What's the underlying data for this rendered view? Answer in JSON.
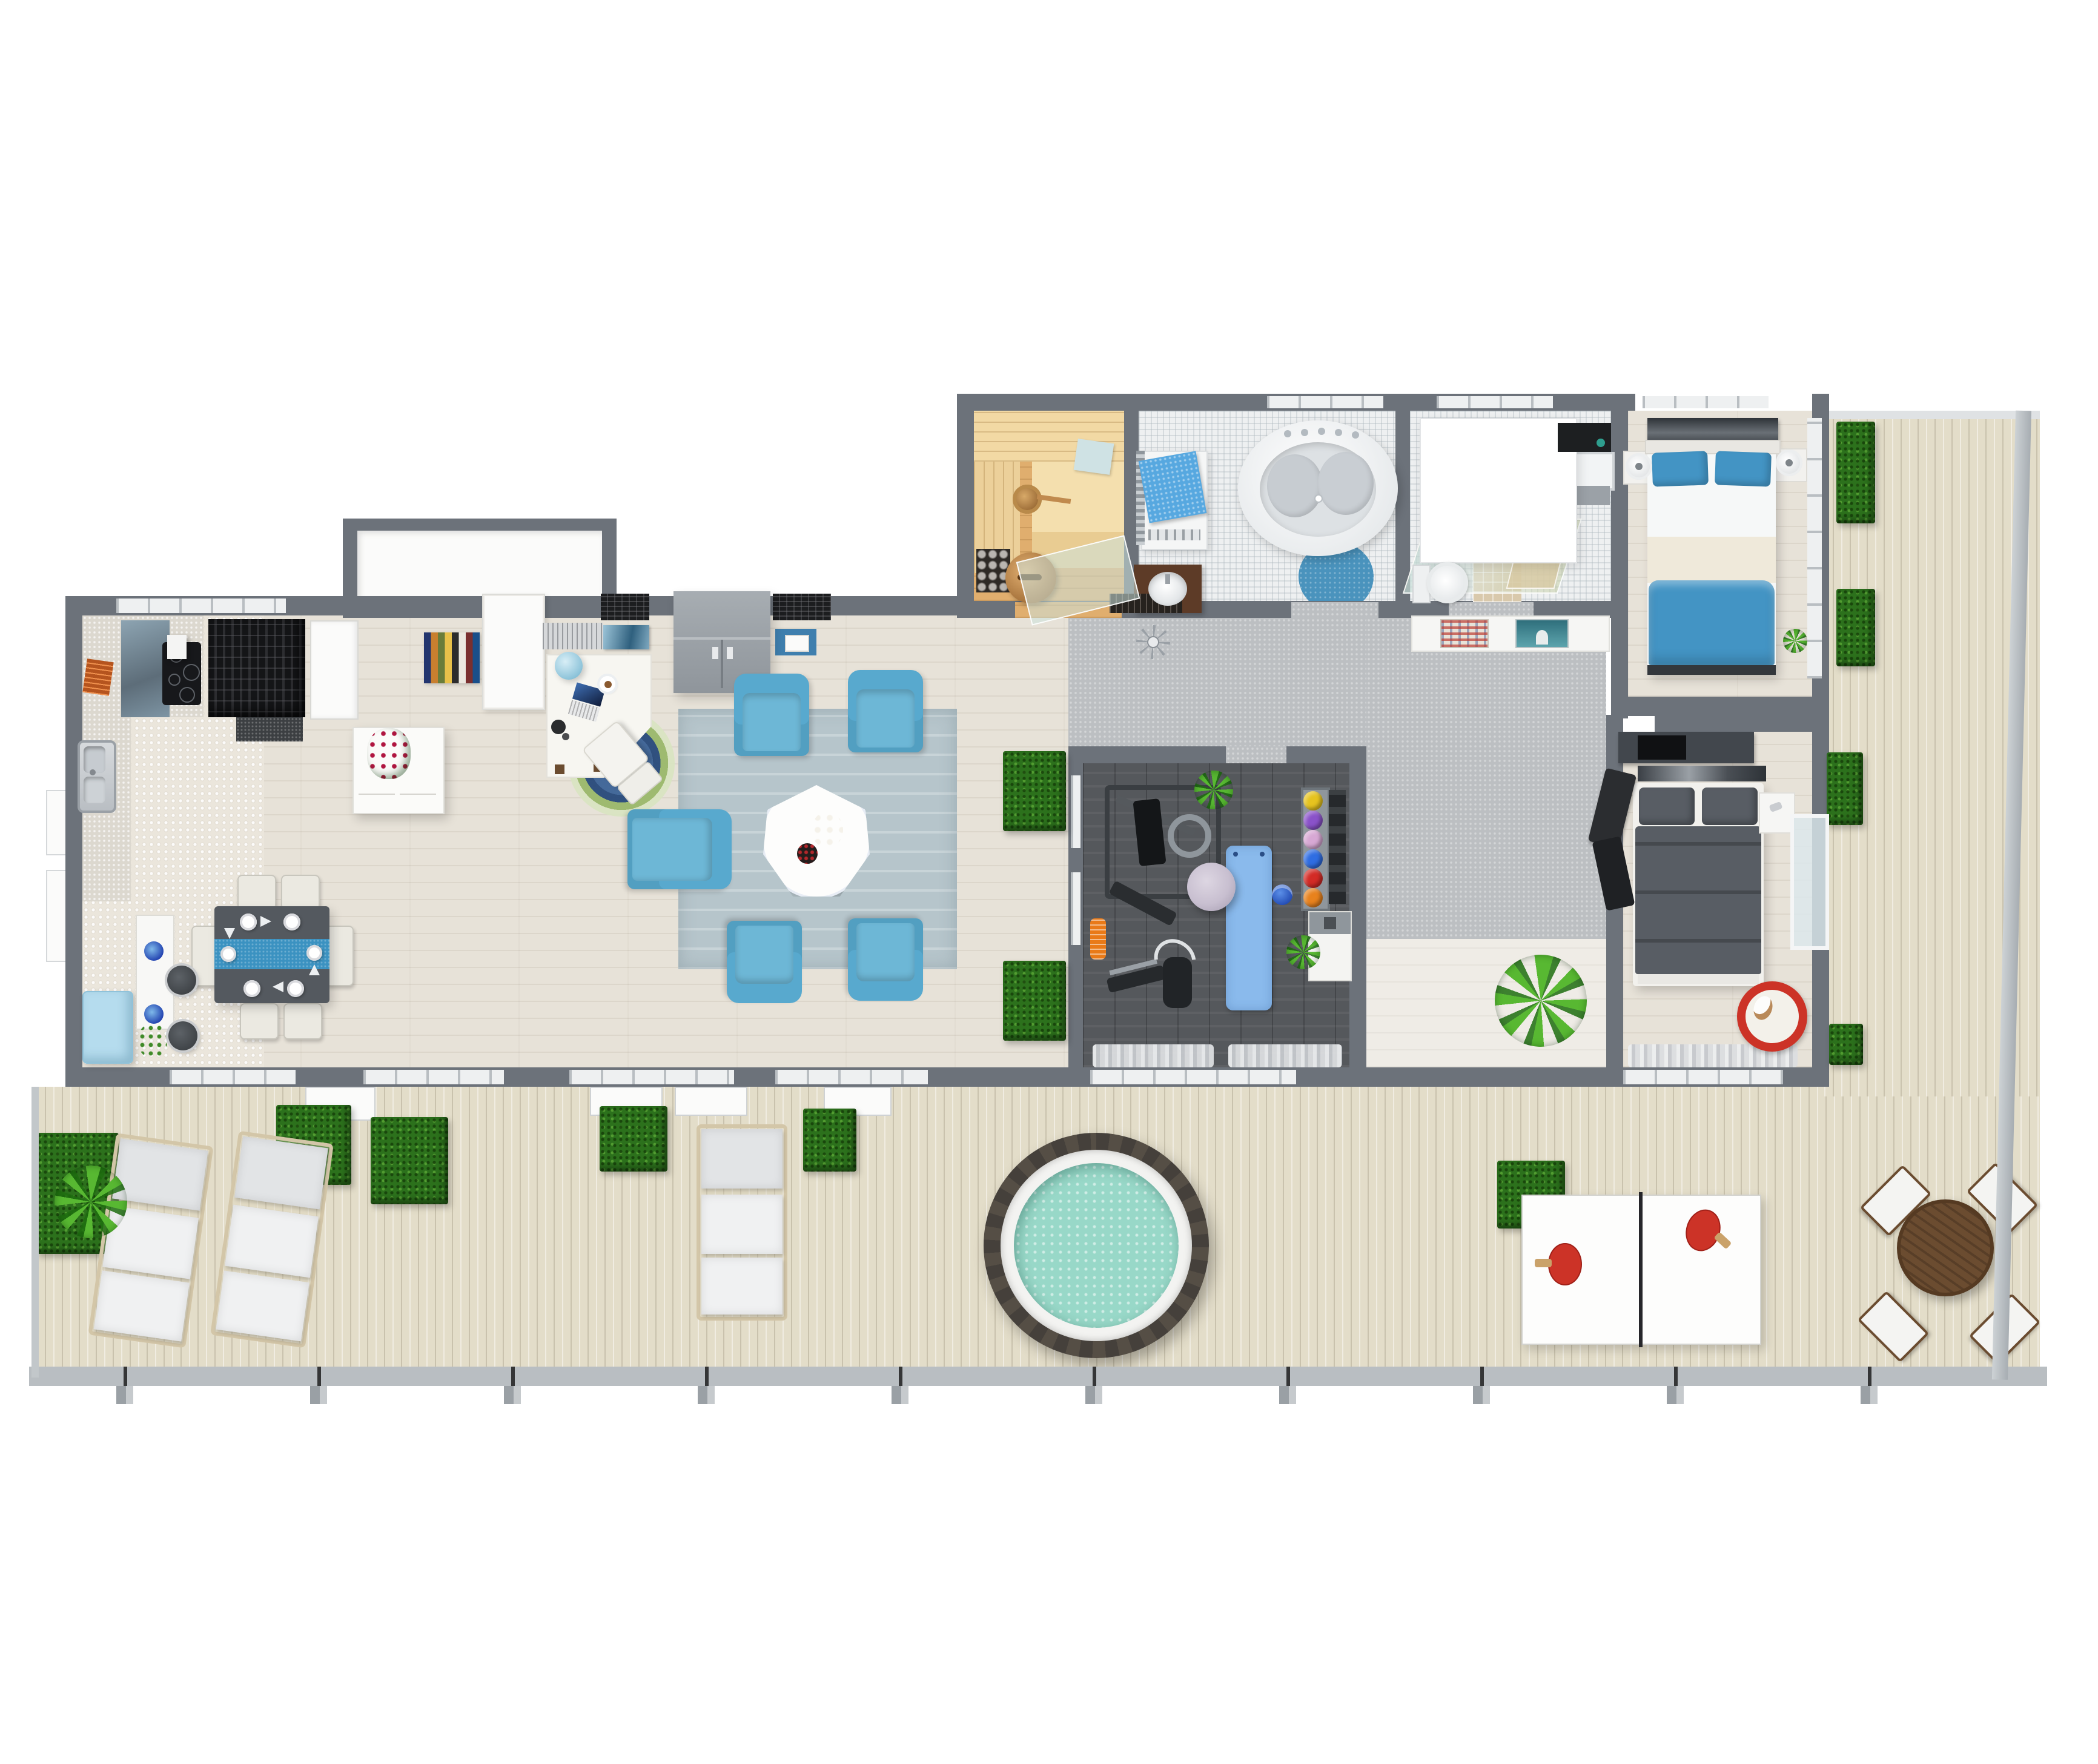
{
  "meta": {
    "title": "3D floor plan — top-down view of a penthouse apartment with large terrace",
    "view": "top-down 3D render",
    "visible_text_fragments": {
      "dog_bed_rim": "JOYFUL CHRISTMAS"
    }
  },
  "palette": {
    "wall": "#6c727a",
    "wood": "#e7e2d8",
    "tile": "#ebe6dc",
    "deck": "#e3ddc9",
    "carpet": "#bcbfc2",
    "gym": "#55585c",
    "bathtile": "#eef0f1",
    "saunawood": "#e0ae6e",
    "saunabench": "#f2d9a4",
    "blue": "#58a9ce",
    "runner": "#3b92c1",
    "teal": "#98d8c8",
    "hedge": "#2c711c",
    "plant": "#58b832",
    "dark": "#54595f",
    "cream": "#ebe9e1",
    "lrug": "#b6c5cb",
    "orug": "#3c6397",
    "bedblue": "#4394c4",
    "bedgray": "#585d64",
    "red": "#cc3327",
    "tubrim": "#45403b",
    "brown": "#6b4c30",
    "orange": "#e97a18",
    "lavender": "#c8bfd0",
    "yogamat": "#8abaec",
    "fridge": "#b5dcee",
    "navyglass": "#5d6d79",
    "black": "#141517"
  },
  "rooms": [
    {
      "id": "kitchen",
      "name": "Kitchen",
      "items": [
        "L-shaped counter",
        "stainless sink",
        "induction cooktop",
        "extractor hood",
        "glass backsplash",
        "black pantry cabinet",
        "integrated white door",
        "white island with flowering plant",
        "light-blue retro fridge",
        "bar counter with 2 blue bowls",
        "red flower vase",
        "2 bar stools",
        "hex-dot tile floor"
      ]
    },
    {
      "id": "dining",
      "name": "Dining area",
      "items": [
        "dark rectangular table",
        "blue table runner",
        "6 place settings",
        "6 cream chairs"
      ]
    },
    {
      "id": "entry",
      "name": "Entry hall",
      "items": [
        "multicolor striped runner rug",
        "white closets",
        "blue doormat with tray"
      ]
    },
    {
      "id": "office",
      "name": "Home office nook",
      "items": [
        "white desk",
        "laptop",
        "coffee cup",
        "desk lamp",
        "blue globe pendant",
        "white chair",
        "blue scalloped round rug",
        "louvered shelf",
        "aquarium picture",
        "dark brick wall panels",
        "gray wardrobe cabinet"
      ]
    },
    {
      "id": "living",
      "name": "Living room",
      "items": [
        "5 blue armchairs",
        "white tri-lobe coffee table",
        "orchid centerpiece",
        "dark round tray",
        "blue-gray rug",
        "2 boxwood hedge cubes"
      ]
    },
    {
      "id": "sauna",
      "name": "Sauna",
      "items": [
        "tiered wood benches",
        "heater stones",
        "wooden bucket with ladle",
        "wooden stool",
        "folded towel",
        "glass door"
      ]
    },
    {
      "id": "bathroom",
      "name": "Bathroom",
      "items": [
        "oval jacuzzi tub with 2 headrests and chrome jets",
        "washing machine with blue towel",
        "towel radiator",
        "dark wood vanity with vessel sink",
        "round blue rug",
        "black bath mat",
        "white mosaic floor"
      ]
    },
    {
      "id": "shower_wc",
      "name": "Shower / WC",
      "items": [
        "white skylight panel",
        "glass shower screens",
        "toilet",
        "black-framed shower cabin",
        "gray cabinet"
      ]
    },
    {
      "id": "hallway",
      "name": "Hallway",
      "items": [
        "gray carpet",
        "ceiling fan",
        "white sideboard with 2 art prints",
        "palm plant"
      ]
    },
    {
      "id": "gym",
      "name": "Home gym",
      "items": [
        "multi-station weight machine",
        "orange foam roller",
        "weight bench",
        "elliptical trainer",
        "lavender exercise ball",
        "blue yoga mat",
        "blue kettlebell",
        "medicine-ball rack (6 balls)",
        "dumbbell column",
        "white locker",
        "2 plants",
        "dark plank floor",
        "curtained windows"
      ]
    },
    {
      "id": "bedroom_master",
      "name": "Bedroom 1 (top)",
      "items": [
        "double bed with blue pillows and blue duvet",
        "artwork above headboard",
        "2 round bedside lamps",
        "plant",
        "window wall to balcony"
      ]
    },
    {
      "id": "bedroom_second",
      "name": "Bedroom 2 (bottom)",
      "items": [
        "double bed with gray bedding",
        "artwork above headboard",
        "dark media cabinet",
        "black lounge chair",
        "white nightstand with phone",
        "red round dog bed with dog",
        "glass balcony door",
        "curtained windows"
      ]
    }
  ],
  "terrace": {
    "name": "Terrace / roof deck",
    "items": [
      "plank decking",
      "glass railing with posts",
      "3 white sun loungers",
      "fern plant",
      "round hot tub with teal water",
      "ping-pong table with 2 red paddles",
      "round wooden dining table",
      "4 white folding sling chairs",
      "10 boxwood hedge cubes",
      "open glass door leaves"
    ]
  },
  "counts": {
    "dining_chairs": 6,
    "armchairs": 5,
    "sun_loungers": 3,
    "terrace_chairs": 4,
    "medicine_balls": 6,
    "hedge_cubes": 10,
    "ping_pong_paddles": 2
  },
  "medicine_ball_colors": [
    "#e6c31f",
    "#8a52c9",
    "#d7a8d4",
    "#2f6de2",
    "#d32b26",
    "#e8821d"
  ],
  "runner_stripe_colors": [
    "#23356e",
    "#c87f2f",
    "#6a7d3a",
    "#e8c14a",
    "#2c2c2c",
    "#ece8e0",
    "#7a2f2f",
    "#1a4f8a"
  ]
}
